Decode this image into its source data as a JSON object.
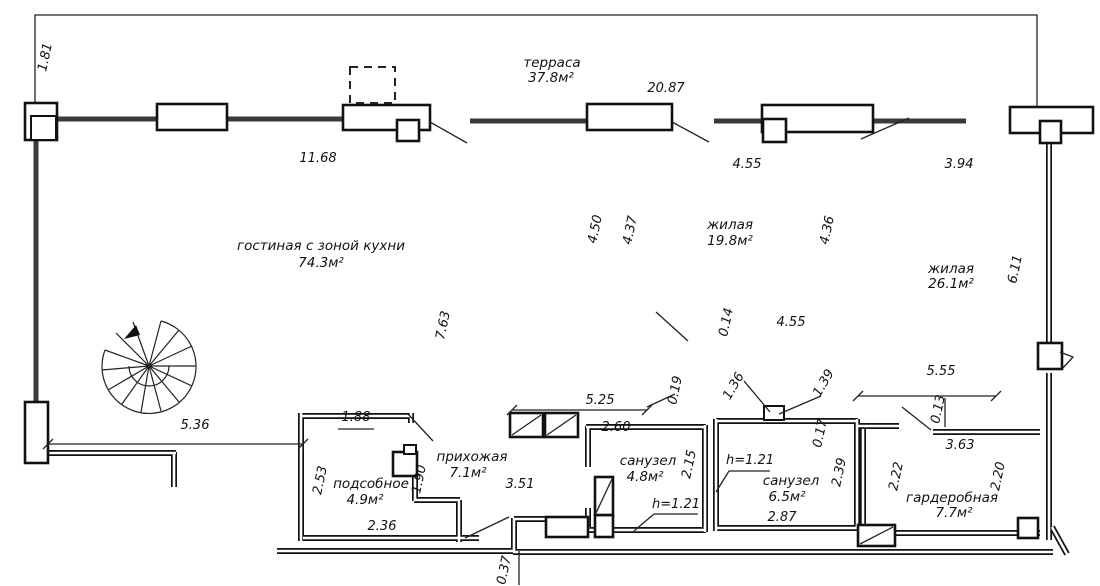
{
  "plan": {
    "rooms": [
      {
        "id": "terrace",
        "label": "терраса",
        "area": "37.8м²"
      },
      {
        "id": "living-kitchen",
        "label": "гостиная с зоной кухни",
        "area": "74.3м²"
      },
      {
        "id": "bedroom-1",
        "label": "жилая",
        "area": "19.8м²"
      },
      {
        "id": "bedroom-2",
        "label": "жилая",
        "area": "26.1м²"
      },
      {
        "id": "hallway",
        "label": "прихожая",
        "area": "7.1м²"
      },
      {
        "id": "utility",
        "label": "подсобное",
        "area": "4.9м²"
      },
      {
        "id": "bathroom-1",
        "label": "санузел",
        "area": "4.8м²"
      },
      {
        "id": "bathroom-2",
        "label": "санузел",
        "area": "6.5м²"
      },
      {
        "id": "wardrobe",
        "label": "гардеробная",
        "area": "7.7м²"
      }
    ],
    "dimensions": {
      "d181": "1.81",
      "d1168": "11.68",
      "d2087": "20.87",
      "d455a": "4.55",
      "d394": "3.94",
      "d450": "4.50",
      "d437": "4.37",
      "d436": "4.36",
      "d611": "6.11",
      "d763": "7.63",
      "d014": "0.14",
      "d455b": "4.55",
      "d536": "5.36",
      "d188": "1.88",
      "d525": "5.25",
      "d260": "2.60",
      "d019": "0.19",
      "d136": "1.36",
      "d139": "1.39",
      "d555": "5.55",
      "d013": "0.13",
      "d363": "3.63",
      "d253": "2.53",
      "d190": "1.90",
      "d236": "2.36",
      "d351": "3.51",
      "d215": "2.15",
      "d239": "2.39",
      "d017": "0.17",
      "d222": "2.22",
      "d220": "2.20",
      "d287": "2.87",
      "d037": "0.37",
      "h121a": "h=1.21",
      "h121b": "h=1.21"
    }
  }
}
